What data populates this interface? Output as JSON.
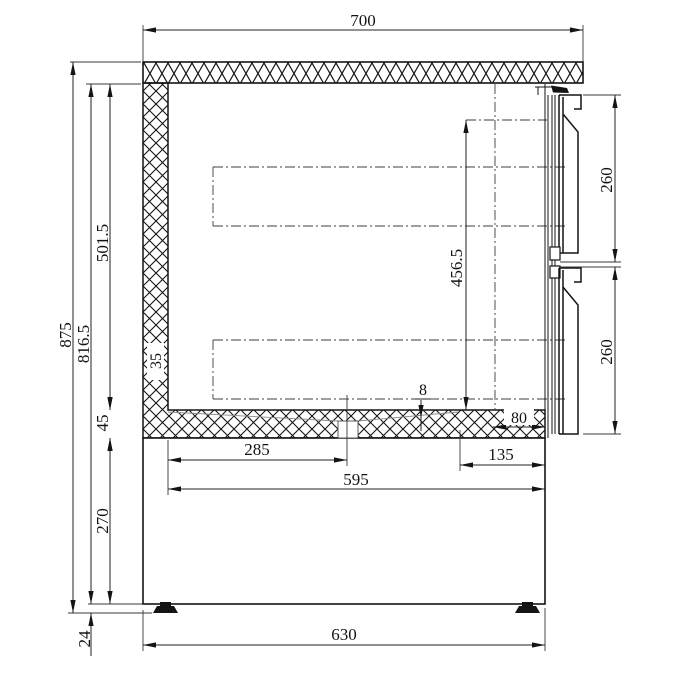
{
  "drawing": {
    "kind": "technical-section-drawing",
    "subject": "refrigerated-counter-two-drawer-side-section",
    "units": "mm",
    "line_color": "#141414",
    "background_color": "#ffffff"
  },
  "dims": {
    "top_width": "700",
    "overall_height": "875",
    "body_height": "816.5",
    "interior_height": "501.5",
    "wall_thickness": "35",
    "floor_thickness": "45",
    "plinth_height": "270",
    "foot_height": "24",
    "drawer_opening_height": "456.5",
    "upper_drawer_front_height": "260",
    "lower_drawer_front_height": "260",
    "floor_fall": "8",
    "rear_floor_depth": "80",
    "drain_offset": "285",
    "front_step_depth": "135",
    "interior_depth": "595",
    "base_depth": "630"
  }
}
